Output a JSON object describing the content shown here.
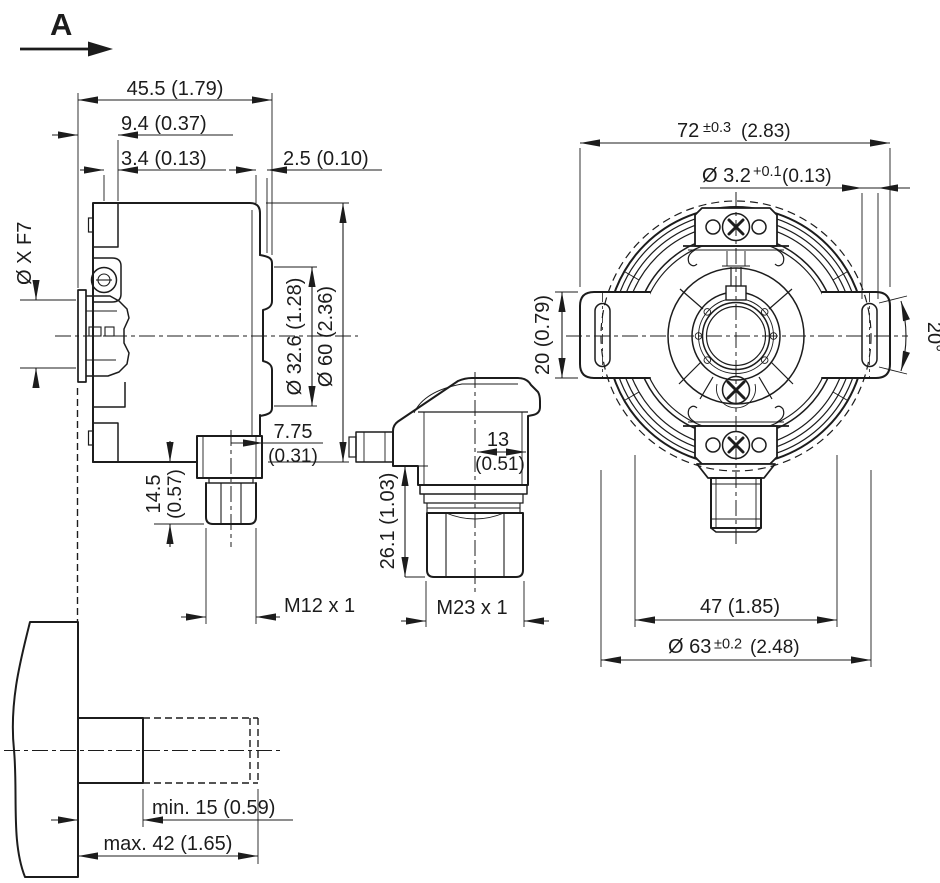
{
  "drawing": {
    "view_label": "A",
    "side_view": {
      "depth_total": "45.5 (1.79)",
      "front_offset": "9.4 (0.37)",
      "step_width": "3.4 (0.13)",
      "rear_lip": "2.5 (0.10)",
      "hollow_shaft_bore": "Ø X F7",
      "clamp_ring_dia": "Ø 32.6 (1.28)",
      "housing_dia": "Ø 60 (2.36)",
      "connector_offset_mm": "7.75",
      "connector_offset_in": "(0.31)",
      "connector_length_mm": "14.5",
      "connector_length_in": "(0.57)",
      "connector_thread": "M12 x 1"
    },
    "connector_view": {
      "lateral_offset_mm": "13",
      "lateral_offset_in": "(0.51)",
      "connector_length": "26.1 (1.03)",
      "connector_thread": "M23 x 1"
    },
    "front_view": {
      "stator_width_mm": "72",
      "stator_width_tol": "±0.3",
      "stator_width_in": "(2.83)",
      "slot_width_dia": "Ø 3.2",
      "slot_width_tol": "+0.1",
      "slot_width_in": "(0.13)",
      "tab_width": "20 (0.79)",
      "slot_angle": "20°",
      "connector_width": "47 (1.85)",
      "flange_dia_mm": "Ø 63",
      "flange_dia_tol": "±0.2",
      "flange_dia_in": "(2.48)"
    },
    "shaft_view": {
      "insertion_min": "min. 15 (0.59)",
      "insertion_max": "max. 42 (1.65)"
    }
  }
}
